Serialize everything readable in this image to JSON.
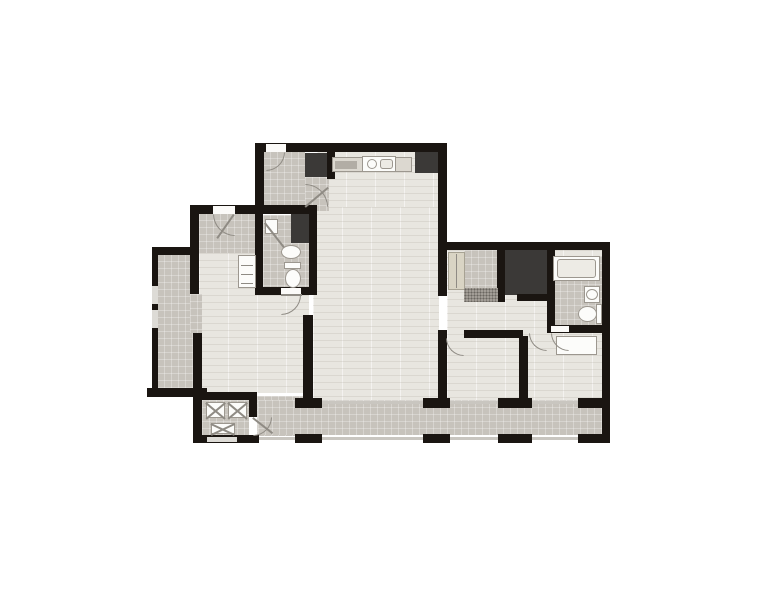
{
  "palette": {
    "wall": "#1a1511",
    "wood": "#e8e6e0",
    "tile": "#c7c3bc",
    "dark": "#3b3937",
    "fixwhite": "#fcfcfa",
    "fixline": "#9c978f",
    "counter": "#dcd8d0",
    "appl": "#b2ada5",
    "panel": "#edebe5",
    "cabinet": "#d9d4c4",
    "cabline": "#a7a293",
    "glass": "#c9c6c0",
    "window": "#dddbd6",
    "gap": "#fbfaf8",
    "doorline": "#8f8b84",
    "mat": "#a29d96",
    "bg": "#ffffff"
  },
  "plan": {
    "elements": [
      {
        "n": "kitchen-floor",
        "t": "wood",
        "x": 317,
        "y": 151,
        "w": 122,
        "h": 62
      },
      {
        "n": "living-room-floor",
        "t": "wood",
        "x": 313,
        "y": 207,
        "w": 126,
        "h": 194
      },
      {
        "n": "bedroom1-floor",
        "t": "wood",
        "x": 199,
        "y": 246,
        "w": 110,
        "h": 147
      },
      {
        "n": "rightwing-floor",
        "t": "wood",
        "x": 447,
        "y": 250,
        "w": 155,
        "h": 151
      },
      {
        "n": "foyer-floor",
        "t": "tile",
        "x": 263,
        "y": 151,
        "w": 42,
        "h": 60
      },
      {
        "n": "foyer-ext-floor",
        "t": "tile",
        "x": 305,
        "y": 177,
        "w": 24,
        "h": 34
      },
      {
        "n": "entry-hall-floor",
        "t": "tile",
        "x": 199,
        "y": 213,
        "w": 58,
        "h": 40
      },
      {
        "n": "bathroom1-floor",
        "t": "tile",
        "x": 263,
        "y": 215,
        "w": 46,
        "h": 74
      },
      {
        "n": "terrace-floor",
        "t": "tile",
        "x": 157,
        "y": 254,
        "w": 36,
        "h": 137
      },
      {
        "n": "terrace-opening-floor",
        "t": "tile",
        "x": 190,
        "y": 294,
        "w": 12,
        "h": 39
      },
      {
        "n": "laundry-floor",
        "t": "tile",
        "x": 202,
        "y": 400,
        "w": 47,
        "h": 36
      },
      {
        "n": "corridor-floor",
        "t": "tile",
        "x": 257,
        "y": 396,
        "w": 53,
        "h": 40
      },
      {
        "n": "balcony-floor",
        "t": "tile",
        "x": 258,
        "y": 400,
        "w": 344,
        "h": 35
      },
      {
        "n": "vestibule-floor",
        "t": "tile",
        "x": 464,
        "y": 250,
        "w": 34,
        "h": 52
      },
      {
        "n": "bathroom2-floor",
        "t": "tile",
        "x": 553,
        "y": 256,
        "w": 49,
        "h": 69
      },
      {
        "n": "foyer-closet",
        "t": "dark",
        "x": 305,
        "y": 153,
        "w": 22,
        "h": 24
      },
      {
        "n": "kitchen-closet",
        "t": "dark",
        "x": 415,
        "y": 152,
        "w": 23,
        "h": 21
      },
      {
        "n": "bathroom1-cabinet",
        "t": "dark",
        "x": 291,
        "y": 214,
        "w": 18,
        "h": 29
      },
      {
        "n": "walkin-closet",
        "t": "dark",
        "x": 505,
        "y": 250,
        "w": 42,
        "h": 45
      },
      {
        "n": "wall-top",
        "t": "wall",
        "x": 255,
        "y": 143,
        "w": 192,
        "h": 9
      },
      {
        "n": "wall-topblock-left",
        "t": "wall",
        "x": 255,
        "y": 143,
        "w": 9,
        "h": 70
      },
      {
        "n": "wall-living-right",
        "t": "wall",
        "x": 438,
        "y": 143,
        "w": 9,
        "h": 110
      },
      {
        "n": "wall-foyer-kitchen",
        "t": "wall",
        "x": 327,
        "y": 151,
        "w": 8,
        "h": 28
      },
      {
        "n": "wall-entry-top",
        "t": "wall",
        "x": 190,
        "y": 205,
        "w": 127,
        "h": 9
      },
      {
        "n": "wall-outer-left-upper",
        "t": "wall",
        "x": 190,
        "y": 214,
        "w": 9,
        "h": 80
      },
      {
        "n": "wall-terrace-top",
        "t": "wall",
        "x": 152,
        "y": 247,
        "w": 42,
        "h": 8
      },
      {
        "n": "wall-terrace-left",
        "t": "wall",
        "x": 152,
        "y": 255,
        "w": 6,
        "h": 137
      },
      {
        "n": "wall-terrace-bottom",
        "t": "wall",
        "x": 147,
        "y": 388,
        "w": 60,
        "h": 9
      },
      {
        "n": "wall-terrace-divider",
        "t": "wall",
        "x": 193,
        "y": 333,
        "w": 9,
        "h": 57
      },
      {
        "n": "wall-laundry-left",
        "t": "wall",
        "x": 193,
        "y": 390,
        "w": 9,
        "h": 53
      },
      {
        "n": "wall-laundry-top",
        "t": "wall",
        "x": 193,
        "y": 392,
        "w": 64,
        "h": 8
      },
      {
        "n": "wall-laundry-right",
        "t": "wall",
        "x": 249,
        "y": 400,
        "w": 8,
        "h": 17
      },
      {
        "n": "wall-laundry-bottom",
        "t": "wall",
        "x": 193,
        "y": 435,
        "w": 66,
        "h": 8
      },
      {
        "n": "wall-bathroom1-left",
        "t": "wall",
        "x": 255,
        "y": 214,
        "w": 8,
        "h": 75
      },
      {
        "n": "wall-bathroom1-right",
        "t": "wall",
        "x": 309,
        "y": 207,
        "w": 8,
        "h": 88
      },
      {
        "n": "wall-bathroom1-bottom",
        "t": "wall",
        "x": 255,
        "y": 287,
        "w": 62,
        "h": 8
      },
      {
        "n": "wall-bedroom1-living",
        "t": "wall",
        "x": 303,
        "y": 315,
        "w": 10,
        "h": 85
      },
      {
        "n": "wall-stub-a",
        "t": "wall",
        "x": 295,
        "y": 398,
        "w": 27,
        "h": 10
      },
      {
        "n": "wall-stub-b",
        "t": "wall",
        "x": 423,
        "y": 398,
        "w": 27,
        "h": 10
      },
      {
        "n": "wall-stub-c",
        "t": "wall",
        "x": 498,
        "y": 398,
        "w": 34,
        "h": 10
      },
      {
        "n": "wall-stub-d",
        "t": "wall",
        "x": 578,
        "y": 398,
        "w": 26,
        "h": 10
      },
      {
        "n": "wall-south-a",
        "t": "wall",
        "x": 295,
        "y": 434,
        "w": 27,
        "h": 9
      },
      {
        "n": "wall-south-b",
        "t": "wall",
        "x": 423,
        "y": 434,
        "w": 27,
        "h": 9
      },
      {
        "n": "wall-south-c",
        "t": "wall",
        "x": 498,
        "y": 434,
        "w": 34,
        "h": 9
      },
      {
        "n": "wall-south-d",
        "t": "wall",
        "x": 578,
        "y": 434,
        "w": 32,
        "h": 9
      },
      {
        "n": "wall-rightwing-top",
        "t": "wall",
        "x": 439,
        "y": 242,
        "w": 171,
        "h": 8
      },
      {
        "n": "wall-outer-right",
        "t": "wall",
        "x": 602,
        "y": 242,
        "w": 8,
        "h": 201
      },
      {
        "n": "wall-living-right-lower",
        "t": "wall",
        "x": 438,
        "y": 250,
        "w": 9,
        "h": 46
      },
      {
        "n": "wall-bedroom2-left",
        "t": "wall",
        "x": 438,
        "y": 330,
        "w": 9,
        "h": 70
      },
      {
        "n": "wall-closet-left",
        "t": "wall",
        "x": 497,
        "y": 250,
        "w": 8,
        "h": 52
      },
      {
        "n": "wall-closet-bottom",
        "t": "wall",
        "x": 517,
        "y": 294,
        "w": 30,
        "h": 7
      },
      {
        "n": "wall-bathroom2-left",
        "t": "wall",
        "x": 547,
        "y": 250,
        "w": 8,
        "h": 83
      },
      {
        "n": "wall-bathroom2-bottom",
        "t": "wall",
        "x": 547,
        "y": 325,
        "w": 63,
        "h": 8
      },
      {
        "n": "wall-bedroom2-top",
        "t": "wall",
        "x": 464,
        "y": 330,
        "w": 59,
        "h": 8
      },
      {
        "n": "wall-bedroom-divider",
        "t": "wall",
        "x": 519,
        "y": 336,
        "w": 9,
        "h": 64
      },
      {
        "n": "entry-door-gap",
        "t": "gap",
        "x": 213,
        "y": 206,
        "w": 22,
        "h": 8
      },
      {
        "n": "service-door-gap",
        "t": "gap",
        "x": 266,
        "y": 144,
        "w": 20,
        "h": 8
      },
      {
        "n": "terrace-window",
        "t": "win",
        "x": 152,
        "y": 286,
        "w": 6,
        "h": 18
      },
      {
        "n": "terrace-window",
        "t": "win",
        "x": 152,
        "y": 310,
        "w": 6,
        "h": 18
      },
      {
        "n": "bathroom1-door-gap",
        "t": "gap",
        "x": 281,
        "y": 288,
        "w": 20,
        "h": 7
      },
      {
        "n": "laundry-window",
        "t": "win",
        "x": 207,
        "y": 437,
        "w": 30,
        "h": 5
      },
      {
        "n": "bathroom2-door-gap",
        "t": "gap",
        "x": 551,
        "y": 326,
        "w": 18,
        "h": 6
      },
      {
        "n": "balcony-door-glass",
        "t": "glass",
        "x": 322,
        "y": 401,
        "w": 101,
        "h": 3
      },
      {
        "n": "balcony-door-glass",
        "t": "glass",
        "x": 450,
        "y": 401,
        "w": 48,
        "h": 3
      },
      {
        "n": "balcony-door-glass",
        "t": "glass",
        "x": 532,
        "y": 401,
        "w": 46,
        "h": 3
      },
      {
        "n": "balcony-rail",
        "t": "glass",
        "x": 259,
        "y": 437,
        "w": 36,
        "h": 3
      },
      {
        "n": "balcony-rail",
        "t": "glass",
        "x": 322,
        "y": 437,
        "w": 101,
        "h": 3
      },
      {
        "n": "balcony-rail",
        "t": "glass",
        "x": 450,
        "y": 437,
        "w": 48,
        "h": 3
      },
      {
        "n": "balcony-rail",
        "t": "glass",
        "x": 532,
        "y": 437,
        "w": 46,
        "h": 3
      },
      {
        "n": "kitchen-counter",
        "t": "counter",
        "x": 332,
        "y": 157,
        "w": 80,
        "h": 15
      },
      {
        "n": "kitchen-appliance",
        "t": "appl",
        "x": 335,
        "y": 161,
        "w": 22,
        "h": 8
      },
      {
        "n": "cooktop",
        "t": "white",
        "x": 362,
        "y": 156,
        "w": 34,
        "h": 16
      },
      {
        "n": "cooktop-burner",
        "t": "circ",
        "x": 367,
        "y": 159,
        "w": 10,
        "h": 10
      },
      {
        "n": "cooktop-panel",
        "t": "panel",
        "x": 380,
        "y": 159,
        "w": 13,
        "h": 10
      },
      {
        "n": "shower-tray",
        "t": "white",
        "x": 265,
        "y": 219,
        "w": 13,
        "h": 15
      },
      {
        "n": "shower-glass",
        "t": "diag",
        "x": 265,
        "y": 222,
        "w": 32,
        "r": 52
      },
      {
        "n": "bathroom1-sink",
        "t": "ell",
        "x": 281,
        "y": 245,
        "w": 20,
        "h": 14
      },
      {
        "n": "bathroom1-toilet-tank",
        "t": "white",
        "x": 284,
        "y": 262,
        "w": 17,
        "h": 7
      },
      {
        "n": "bathroom1-toilet",
        "t": "ell",
        "x": 285,
        "y": 269,
        "w": 16,
        "h": 19
      },
      {
        "n": "hall-vanity",
        "t": "white",
        "x": 238,
        "y": 255,
        "w": 18,
        "h": 33
      },
      {
        "n": "vanity-shelf",
        "t": "line",
        "x": 241,
        "y": 265,
        "w": 12,
        "h": 1
      },
      {
        "n": "vanity-shelf",
        "t": "line",
        "x": 241,
        "y": 274,
        "w": 12,
        "h": 1
      },
      {
        "n": "vanity-shelf",
        "t": "line",
        "x": 241,
        "y": 283,
        "w": 12,
        "h": 1
      },
      {
        "n": "laundry-unit",
        "t": "white",
        "x": 206,
        "y": 402,
        "w": 19,
        "h": 16
      },
      {
        "n": "laundry-unit-x",
        "t": "diag",
        "x": 206,
        "y": 402,
        "w": 25,
        "r": 40
      },
      {
        "n": "laundry-unit-x",
        "t": "diag",
        "x": 206,
        "y": 418,
        "w": 25,
        "r": -40
      },
      {
        "n": "laundry-unit",
        "t": "white",
        "x": 228,
        "y": 402,
        "w": 19,
        "h": 16
      },
      {
        "n": "laundry-unit-x",
        "t": "diag",
        "x": 228,
        "y": 402,
        "w": 25,
        "r": 40
      },
      {
        "n": "laundry-unit-x",
        "t": "diag",
        "x": 228,
        "y": 418,
        "w": 25,
        "r": -40
      },
      {
        "n": "storage-box",
        "t": "white",
        "x": 211,
        "y": 423,
        "w": 24,
        "h": 11
      },
      {
        "n": "storage-box-x",
        "t": "diag",
        "x": 211,
        "y": 423,
        "w": 26,
        "r": 25
      },
      {
        "n": "storage-box-x",
        "t": "diag",
        "x": 211,
        "y": 434,
        "w": 26,
        "r": -25
      },
      {
        "n": "hall-wardrobe",
        "t": "cab",
        "x": 448,
        "y": 252,
        "w": 17,
        "h": 38
      },
      {
        "n": "wardrobe-divider",
        "t": "line",
        "x": 456,
        "y": 254,
        "w": 1,
        "h": 34
      },
      {
        "n": "entry-mat",
        "t": "mat",
        "x": 464,
        "y": 288,
        "w": 34,
        "h": 14
      },
      {
        "n": "bathtub",
        "t": "white",
        "x": 553,
        "y": 256,
        "w": 47,
        "h": 25
      },
      {
        "n": "bathtub-inner",
        "t": "panel",
        "x": 557,
        "y": 259,
        "w": 39,
        "h": 19
      },
      {
        "n": "bathroom2-sink",
        "t": "white",
        "x": 584,
        "y": 286,
        "w": 16,
        "h": 17
      },
      {
        "n": "bathroom2-sink-bowl",
        "t": "ell",
        "x": 586,
        "y": 289,
        "w": 12,
        "h": 11
      },
      {
        "n": "bathroom2-toilet",
        "t": "ell",
        "x": 578,
        "y": 306,
        "w": 19,
        "h": 16
      },
      {
        "n": "bathroom2-toilet-tank",
        "t": "white",
        "x": 596,
        "y": 304,
        "w": 6,
        "h": 20
      },
      {
        "n": "bedroom3-desk",
        "t": "white",
        "x": 556,
        "y": 336,
        "w": 41,
        "h": 19
      },
      {
        "n": "entry-door-swing",
        "t": "arc",
        "x": 213,
        "y": 214,
        "w": 22,
        "h": 22,
        "c": "tr"
      },
      {
        "n": "entry-door-leaf",
        "t": "diag",
        "x": 234,
        "y": 214,
        "w": 29,
        "r": 125
      },
      {
        "n": "service-door-swing",
        "t": "arc",
        "x": 266,
        "y": 152,
        "w": 19,
        "h": 19,
        "c": "tl"
      },
      {
        "n": "foyer-door-swing",
        "t": "arc",
        "x": 305,
        "y": 184,
        "w": 23,
        "h": 23,
        "c": "bl"
      },
      {
        "n": "foyer-door-leaf",
        "t": "diag",
        "x": 305,
        "y": 206,
        "w": 30,
        "r": -40
      },
      {
        "n": "bathroom1-door-swing",
        "t": "arc",
        "x": 281,
        "y": 295,
        "w": 20,
        "h": 20,
        "c": "tl"
      },
      {
        "n": "bathroom1-door-leaf",
        "t": "line",
        "x": 281,
        "y": 294,
        "w": 21,
        "h": 2
      },
      {
        "n": "laundry-door-swing",
        "t": "arc",
        "x": 253,
        "y": 417,
        "w": 19,
        "h": 19,
        "c": "tl"
      },
      {
        "n": "laundry-door-leaf",
        "t": "diag",
        "x": 253,
        "y": 417,
        "w": 25,
        "r": 38
      },
      {
        "n": "bathroom2-door-swing",
        "t": "arc",
        "x": 551,
        "y": 333,
        "w": 18,
        "h": 18,
        "c": "tr"
      },
      {
        "n": "bedroom2-door-swing",
        "t": "arc",
        "x": 446,
        "y": 338,
        "w": 18,
        "h": 18,
        "c": "tr"
      },
      {
        "n": "bedroom3-door-swing",
        "t": "arc",
        "x": 529,
        "y": 333,
        "w": 18,
        "h": 18,
        "c": "tr"
      }
    ]
  }
}
